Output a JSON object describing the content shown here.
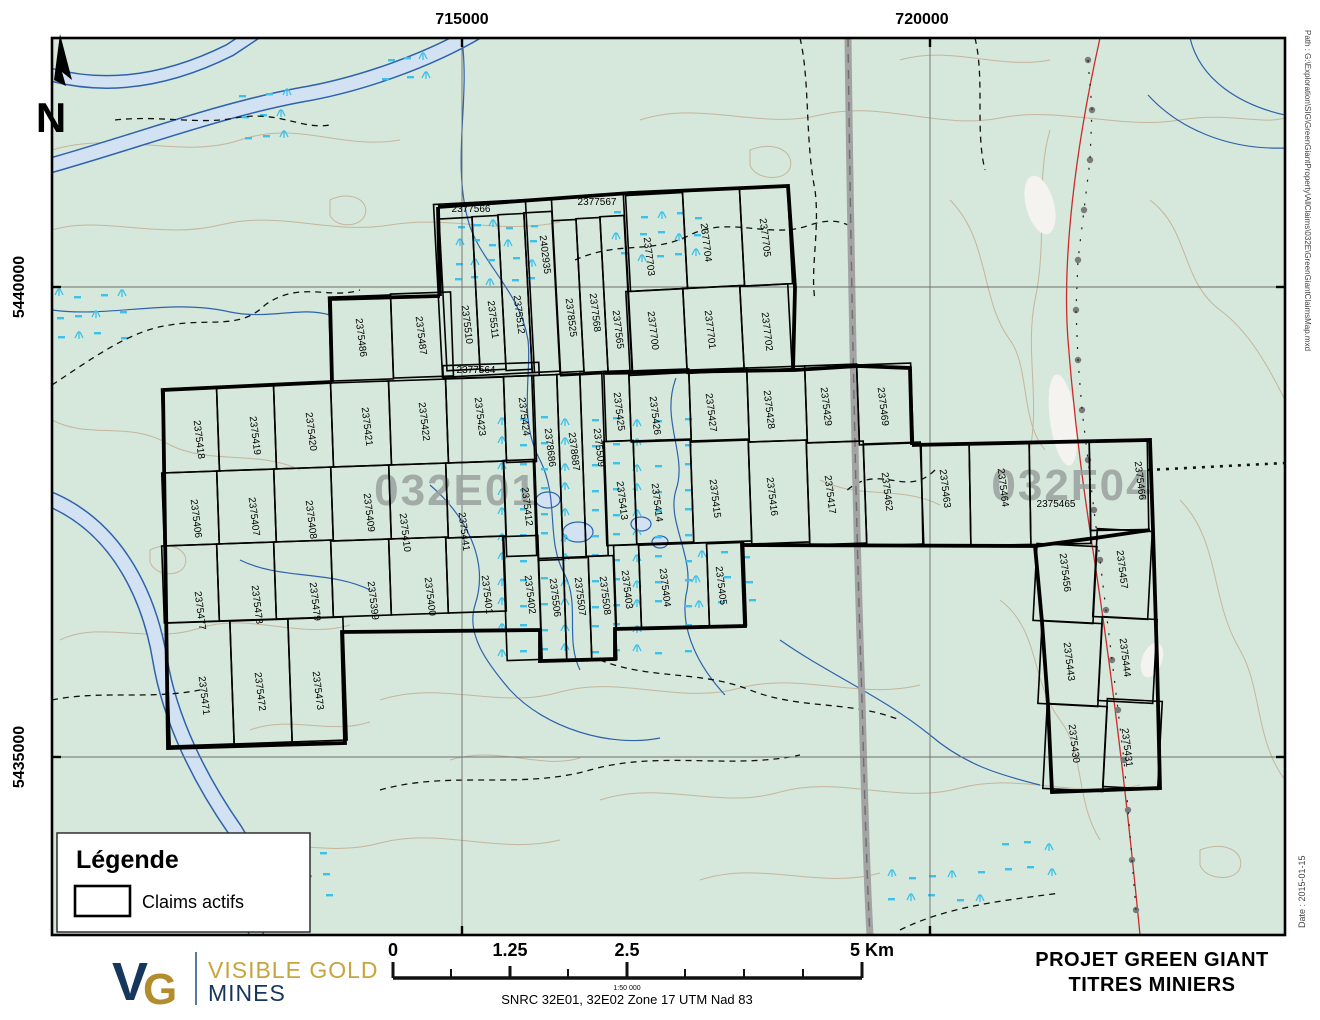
{
  "map": {
    "grid": {
      "top_labels": [
        {
          "text": "715000",
          "x": 462
        },
        {
          "text": "720000",
          "x": 922
        }
      ],
      "left_labels": [
        {
          "text": "5440000",
          "y": 287
        },
        {
          "text": "5435000",
          "y": 757
        }
      ]
    },
    "north_label": "N",
    "zone_labels": [
      {
        "text": "032E01",
        "x": 456,
        "y": 505
      },
      {
        "text": "032F04",
        "x": 1072,
        "y": 500
      }
    ],
    "legend": {
      "title": "Légende",
      "items": [
        {
          "symbol": "claim-rect",
          "label": "Claims actifs"
        }
      ]
    },
    "claims": [
      {
        "id": "2377566",
        "cell": [
          438,
          202,
          92,
          173,
          -3
        ],
        "label": [
          471,
          212,
          0
        ]
      },
      {
        "id": "2375510",
        "cell": [
          443,
          218,
          33,
          152,
          -3
        ],
        "label": [
          464,
          325,
          83
        ]
      },
      {
        "id": "2375511",
        "cell": [
          476,
          216,
          26,
          154,
          -3
        ],
        "label": [
          490,
          320,
          83
        ]
      },
      {
        "id": "2375512",
        "cell": [
          502,
          214,
          26,
          156,
          -3
        ],
        "label": [
          516,
          315,
          83
        ]
      },
      {
        "id": "2402935",
        "cell": [
          528,
          212,
          28,
          160,
          -3
        ],
        "label": [
          542,
          255,
          83
        ]
      },
      {
        "id": "2377567",
        "cell": [
          556,
          196,
          72,
          178,
          -3
        ],
        "label": [
          597,
          205,
          0
        ]
      },
      {
        "id": "2378525",
        "cell": [
          556,
          220,
          24,
          152,
          -3
        ],
        "label": [
          568,
          318,
          83
        ]
      },
      {
        "id": "2377568",
        "cell": [
          580,
          218,
          24,
          154,
          -3
        ],
        "label": [
          592,
          313,
          83
        ]
      },
      {
        "id": "2377565",
        "cell": [
          604,
          216,
          24,
          156,
          -3
        ],
        "label": [
          615,
          330,
          83
        ]
      },
      {
        "id": "2377703",
        "cell": [
          628,
          194,
          57,
          96,
          -3
        ],
        "label": [
          646,
          257,
          83
        ]
      },
      {
        "id": "2377704",
        "cell": [
          685,
          190,
          57,
          97,
          -3
        ],
        "label": [
          703,
          243,
          83
        ]
      },
      {
        "id": "2377705",
        "cell": [
          742,
          187,
          48,
          98,
          -3
        ],
        "label": [
          762,
          238,
          83
        ]
      },
      {
        "id": "2377700",
        "cell": [
          628,
          290,
          57,
          84,
          -3
        ],
        "label": [
          650,
          331,
          83
        ]
      },
      {
        "id": "2377701",
        "cell": [
          685,
          287,
          57,
          85,
          -3
        ],
        "label": [
          707,
          330,
          83
        ]
      },
      {
        "id": "2377702",
        "cell": [
          742,
          285,
          48,
          85,
          -3
        ],
        "label": [
          764,
          332,
          83
        ]
      },
      {
        "id": "2377564",
        "cell": [
          443,
          364,
          96,
          13,
          -2
        ],
        "label": [
          476,
          373,
          0
        ]
      },
      {
        "id": "2375486",
        "cell": [
          330,
          296,
          62,
          84,
          -2
        ],
        "label": [
          358,
          338,
          83
        ]
      },
      {
        "id": "2375487",
        "cell": [
          392,
          293,
          60,
          84,
          -2
        ],
        "label": [
          418,
          336,
          83
        ]
      },
      {
        "id": "2375418",
        "cell": [
          163,
          388,
          55,
          84,
          -2
        ],
        "label": [
          196,
          440,
          83
        ]
      },
      {
        "id": "2375419",
        "cell": [
          218,
          386,
          57,
          84,
          -2
        ],
        "label": [
          252,
          436,
          83
        ]
      },
      {
        "id": "2375420",
        "cell": [
          275,
          384,
          57,
          84,
          -2
        ],
        "label": [
          308,
          432,
          83
        ]
      },
      {
        "id": "2375421",
        "cell": [
          332,
          382,
          58,
          84,
          -2
        ],
        "label": [
          364,
          427,
          83
        ]
      },
      {
        "id": "2375422",
        "cell": [
          390,
          380,
          57,
          84,
          -2
        ],
        "label": [
          421,
          422,
          83
        ]
      },
      {
        "id": "2375423",
        "cell": [
          447,
          378,
          58,
          84,
          -2
        ],
        "label": [
          477,
          417,
          83
        ]
      },
      {
        "id": "2375424",
        "cell": [
          505,
          376,
          30,
          86,
          -2
        ],
        "label": [
          521,
          417,
          83
        ]
      },
      {
        "id": "2378686",
        "cell": [
          535,
          375,
          25,
          185,
          -2
        ],
        "label": [
          547,
          448,
          83
        ]
      },
      {
        "id": "2378687",
        "cell": [
          560,
          374,
          23,
          184,
          -2
        ],
        "label": [
          571,
          452,
          83
        ]
      },
      {
        "id": "2375509",
        "cell": [
          583,
          373,
          22,
          183,
          -2
        ],
        "label": [
          596,
          448,
          83
        ]
      },
      {
        "id": "2375425",
        "cell": [
          605,
          371,
          25,
          70,
          -2
        ],
        "label": [
          616,
          412,
          83
        ]
      },
      {
        "id": "2375426",
        "cell": [
          630,
          370,
          60,
          71,
          -2
        ],
        "label": [
          652,
          416,
          83
        ]
      },
      {
        "id": "2375427",
        "cell": [
          690,
          369,
          58,
          72,
          -2
        ],
        "label": [
          708,
          413,
          83
        ]
      },
      {
        "id": "2375428",
        "cell": [
          748,
          367,
          58,
          74,
          -2
        ],
        "label": [
          766,
          410,
          83
        ]
      },
      {
        "id": "2375429",
        "cell": [
          806,
          365,
          52,
          77,
          -2
        ],
        "label": [
          823,
          407,
          83
        ]
      },
      {
        "id": "2375469",
        "cell": [
          858,
          364,
          54,
          80,
          -2
        ],
        "label": [
          880,
          407,
          83
        ]
      },
      {
        "id": "2375406",
        "cell": [
          163,
          472,
          55,
          73,
          -2
        ],
        "label": [
          193,
          519,
          83
        ]
      },
      {
        "id": "2375407",
        "cell": [
          218,
          470,
          57,
          73,
          -2
        ],
        "label": [
          251,
          517,
          83
        ]
      },
      {
        "id": "2375408",
        "cell": [
          275,
          468,
          57,
          73,
          -2
        ],
        "label": [
          308,
          520,
          83
        ]
      },
      {
        "id": "2375409",
        "cell": [
          332,
          466,
          58,
          74,
          -2
        ],
        "label": [
          366,
          513,
          83
        ]
      },
      {
        "id": "2375410",
        "cell": [
          390,
          464,
          57,
          74,
          -2
        ],
        "label": [
          402,
          533,
          83
        ]
      },
      {
        "id": "2375441",
        "cell": [
          447,
          462,
          58,
          75,
          -2
        ],
        "label": [
          461,
          532,
          83
        ]
      },
      {
        "id": "2375412",
        "cell": [
          505,
          460,
          30,
          96,
          -2
        ],
        "label": [
          524,
          507,
          83
        ]
      },
      {
        "id": "2375413",
        "cell": [
          605,
          441,
          30,
          104,
          -2
        ],
        "label": [
          619,
          501,
          83
        ]
      },
      {
        "id": "2375414",
        "cell": [
          635,
          440,
          57,
          103,
          -2
        ],
        "label": [
          654,
          503,
          83
        ]
      },
      {
        "id": "2375415",
        "cell": [
          692,
          440,
          58,
          102,
          -2
        ],
        "label": [
          712,
          499,
          83
        ]
      },
      {
        "id": "2375416",
        "cell": [
          750,
          441,
          58,
          102,
          -2
        ],
        "label": [
          769,
          497,
          83
        ]
      },
      {
        "id": "2375417",
        "cell": [
          808,
          442,
          57,
          102,
          -2
        ],
        "label": [
          827,
          495,
          83
        ]
      },
      {
        "id": "2375462",
        "cell": [
          865,
          443,
          57,
          102,
          -2
        ],
        "label": [
          884,
          492,
          83
        ]
      },
      {
        "id": "2375463",
        "cell": [
          922,
          444,
          48,
          102,
          -1
        ],
        "label": [
          942,
          489,
          83
        ]
      },
      {
        "id": "2375464",
        "cell": [
          970,
          443,
          60,
          102,
          -1
        ],
        "label": [
          1000,
          488,
          83
        ]
      },
      {
        "id": "2375465",
        "cell": [
          1030,
          442,
          60,
          102,
          -1
        ],
        "label": [
          1056,
          507,
          0
        ]
      },
      {
        "id": "2375466",
        "cell": [
          1090,
          440,
          58,
          90,
          -1
        ],
        "label": [
          1137,
          481,
          83
        ]
      },
      {
        "id": "2375477",
        "cell": [
          163,
          545,
          55,
          77,
          -2
        ],
        "label": [
          197,
          611,
          83
        ]
      },
      {
        "id": "2375478",
        "cell": [
          218,
          543,
          57,
          77,
          -2
        ],
        "label": [
          254,
          605,
          83
        ]
      },
      {
        "id": "2375479",
        "cell": [
          275,
          541,
          57,
          77,
          -2
        ],
        "label": [
          312,
          602,
          83
        ]
      },
      {
        "id": "2375399",
        "cell": [
          332,
          540,
          58,
          76,
          -2
        ],
        "label": [
          370,
          601,
          83
        ]
      },
      {
        "id": "2375400",
        "cell": [
          390,
          538,
          57,
          76,
          -2
        ],
        "label": [
          427,
          597,
          83
        ]
      },
      {
        "id": "2375401",
        "cell": [
          447,
          537,
          58,
          75,
          -2
        ],
        "label": [
          484,
          595,
          83
        ]
      },
      {
        "id": "2375402",
        "cell": [
          505,
          536,
          35,
          124,
          -2
        ],
        "label": [
          527,
          595,
          83
        ]
      },
      {
        "id": "2375506",
        "cell": [
          540,
          558,
          25,
          102,
          -2
        ],
        "label": [
          552,
          598,
          83
        ]
      },
      {
        "id": "2375507",
        "cell": [
          565,
          557,
          25,
          103,
          -2
        ],
        "label": [
          577,
          597,
          83
        ]
      },
      {
        "id": "2375508",
        "cell": [
          590,
          556,
          25,
          104,
          -2
        ],
        "label": [
          602,
          596,
          83
        ]
      },
      {
        "id": "2375403",
        "cell": [
          615,
          545,
          25,
          83,
          -2
        ],
        "label": [
          624,
          590,
          83
        ]
      },
      {
        "id": "2375404",
        "cell": [
          640,
          544,
          68,
          83,
          -2
        ],
        "label": [
          662,
          588,
          83
        ]
      },
      {
        "id": "2375405",
        "cell": [
          708,
          543,
          37,
          83,
          -2
        ],
        "label": [
          718,
          586,
          83
        ]
      },
      {
        "id": "2375471",
        "cell": [
          168,
          622,
          64,
          123,
          -2
        ],
        "label": [
          201,
          696,
          83
        ]
      },
      {
        "id": "2375472",
        "cell": [
          232,
          620,
          58,
          123,
          -2
        ],
        "label": [
          257,
          692,
          83
        ]
      },
      {
        "id": "2375473",
        "cell": [
          290,
          618,
          55,
          123,
          -2
        ],
        "label": [
          315,
          691,
          83
        ]
      },
      {
        "id": "2375456",
        "cell": [
          1035,
          545,
          60,
          77,
          3
        ],
        "label": [
          1062,
          573,
          83
        ]
      },
      {
        "id": "2375457",
        "cell": [
          1095,
          530,
          55,
          88,
          3
        ],
        "label": [
          1119,
          570,
          83
        ]
      },
      {
        "id": "2375443",
        "cell": [
          1040,
          622,
          60,
          83,
          3
        ],
        "label": [
          1066,
          662,
          83
        ]
      },
      {
        "id": "2375444",
        "cell": [
          1100,
          618,
          55,
          84,
          3
        ],
        "label": [
          1122,
          658,
          83
        ]
      },
      {
        "id": "2375430",
        "cell": [
          1045,
          705,
          60,
          85,
          3
        ],
        "label": [
          1071,
          744,
          83
        ]
      },
      {
        "id": "2375431",
        "cell": [
          1105,
          700,
          55,
          88,
          3
        ],
        "label": [
          1124,
          748,
          83
        ]
      }
    ]
  },
  "margins": {
    "path_text": "Path : G:\\Exploration\\SIG\\GreenGiantProperty\\AllClaims\\032E\\GreenGiantClaimsMap.mxd",
    "date_text": "Date : 2015-01-15"
  },
  "footer": {
    "logo": {
      "mark_v": "V",
      "mark_g": "G",
      "line1": "VISIBLE GOLD",
      "line2": "MINES"
    },
    "scalebar": {
      "labels": [
        {
          "text": "0",
          "x": 393
        },
        {
          "text": "1.25",
          "x": 510
        },
        {
          "text": "2.5",
          "x": 627
        },
        {
          "text": "5 Km",
          "x": 872
        }
      ],
      "ratio": "1:50 000",
      "projection": "SNRC 32E01, 32E02  Zone 17 UTM Nad 83"
    },
    "title_line1": "PROJET GREEN GIANT",
    "title_line2": "TITRES MINIERS"
  },
  "colors": {
    "background": "#d5e8db",
    "water_fill": "#d3e2f3",
    "water_line": "#2e62ac",
    "contour": "#c6b59c",
    "marsh": "#3bc1ea",
    "road": "#a3a3a3",
    "red_line": "#cc2b2b",
    "zone_label": "#9aa19e",
    "gold": "#c8a43c",
    "navy": "#16365c"
  }
}
